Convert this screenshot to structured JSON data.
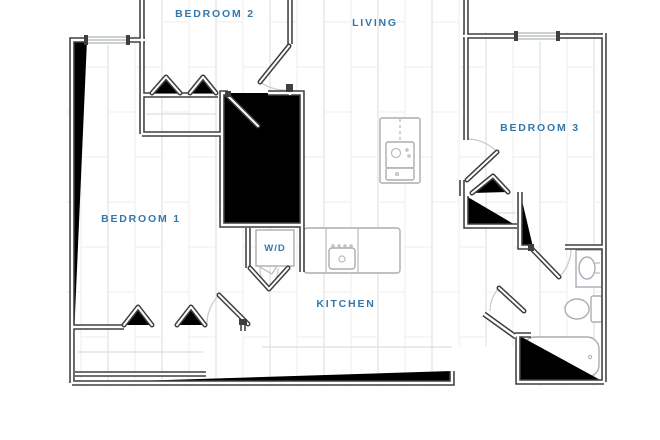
{
  "page_title": "apartment-floor-plan",
  "rooms": {
    "bedroom_1": "BEDROOM 1",
    "bedroom_2": "BEDROOM 2",
    "bedroom_3": "BEDROOM 3",
    "living": "LIVING",
    "kitchen": "KITCHEN",
    "washer_dryer": "W/D"
  },
  "colors": {
    "room_label_blue": "#3378ad",
    "wall_dark": "#3f3f3f",
    "fixture_outline_gray": "#a9aeb2",
    "floor_plank_line": "#ededed",
    "door_arc_gray": "#c6cacc"
  },
  "icons": [
    "bathtub-icon",
    "toilet-icon",
    "sink-vanity-icon",
    "kitchen-sink-icon",
    "washer-icon",
    "kitchen-island-icon",
    "window-icon",
    "door-swing-icon",
    "bifold-closet-door-icon"
  ]
}
